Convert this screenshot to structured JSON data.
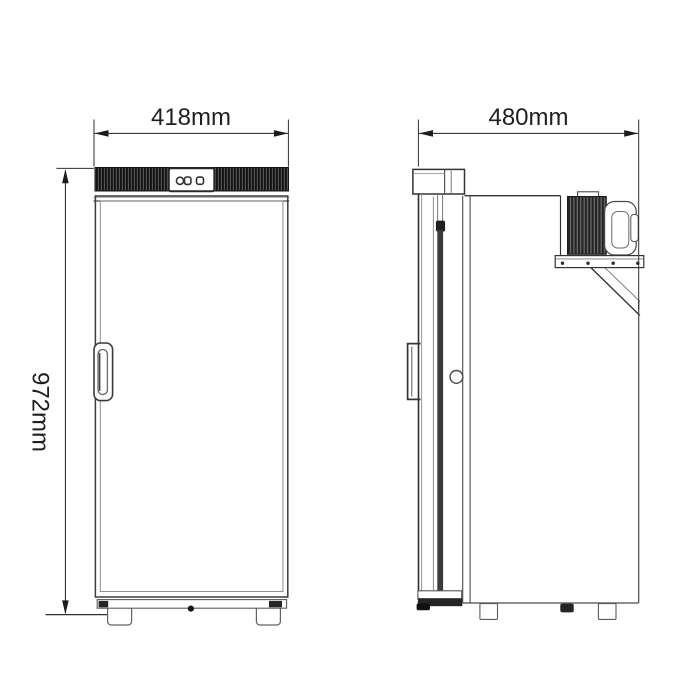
{
  "page": {
    "background_color": "#ffffff"
  },
  "drawing": {
    "type": "two-view-dimensional-technical-drawing",
    "subject": "compressor-refrigerator",
    "line_color": "#2f2f2f",
    "dimension_color": "#1c1c1c",
    "views": {
      "front": "front-elevation",
      "side": "side-elevation"
    },
    "dimensions": {
      "width": "418mm",
      "height": "972mm",
      "depth": "480mm"
    }
  }
}
